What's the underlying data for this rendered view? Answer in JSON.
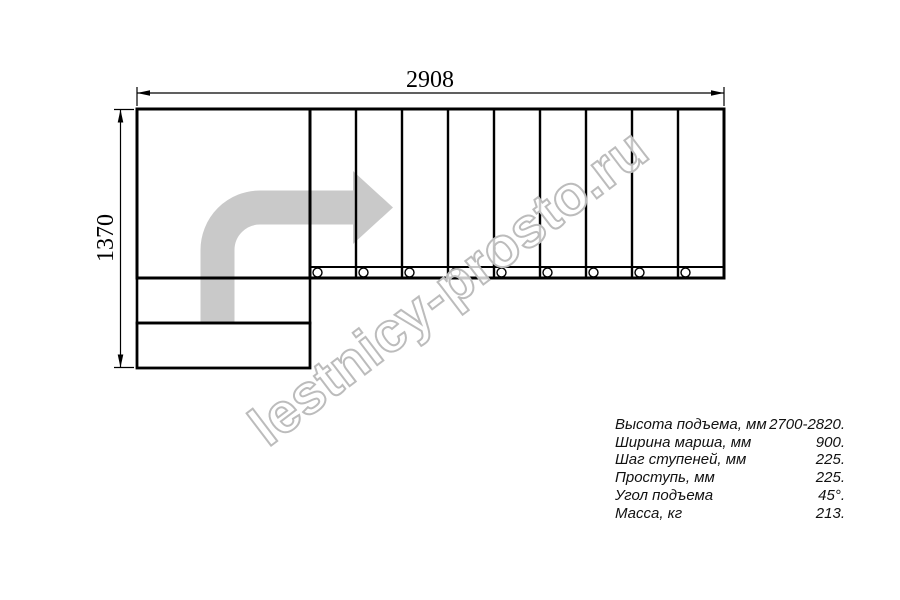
{
  "watermark": "lestnicy-prosto.ru",
  "dimensions": {
    "width_mm": "2908",
    "height_mm": "1370"
  },
  "specs": {
    "rows": [
      {
        "label": "Высота подъема, мм",
        "value": "2700-2820."
      },
      {
        "label": "Ширина марша, мм",
        "value": "900."
      },
      {
        "label": "Шаг ступеней, мм",
        "value": "225."
      },
      {
        "label": "Проступь, мм",
        "value": "225."
      },
      {
        "label": "Угол подъема",
        "value": "45°."
      },
      {
        "label": "Масса, кг",
        "value": "213."
      }
    ]
  },
  "plan": {
    "type": "l-shaped-staircase-top-view",
    "straight_flight_treads": 9,
    "bottom_entry_steps": 2,
    "balusters": 9,
    "turn": "90-degree",
    "walk_direction": "up-then-right"
  },
  "colors": {
    "line": "#000000",
    "arrow_fill": "#c9c9c9",
    "watermark_outline": "#bcbcbc"
  }
}
